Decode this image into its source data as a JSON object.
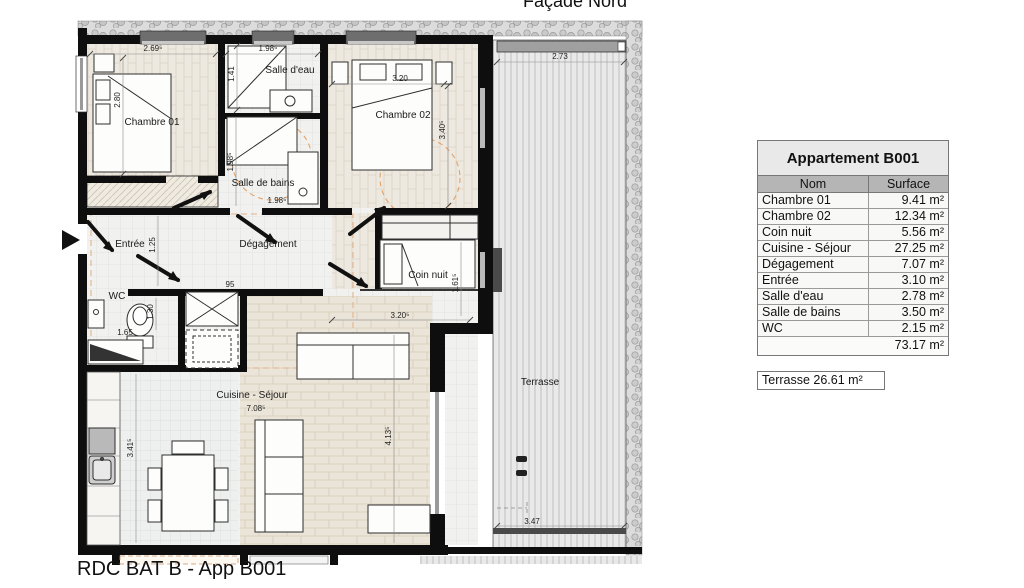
{
  "page": {
    "title": "Façade Nord",
    "footer": "RDC BAT B - App B001"
  },
  "plan": {
    "rooms": {
      "chambre01": "Chambre 01",
      "salle_eau": "Salle d'eau",
      "chambre02": "Chambre 02",
      "salle_bains": "Salle de bains",
      "entree": "Entrée",
      "degagement": "Dégagement",
      "coin_nuit": "Coin nuit",
      "wc": "WC",
      "cuisine_sejour": "Cuisine - Séjour",
      "terrasse": "Terrasse"
    },
    "dims": {
      "ch01_w": "2.69⁵",
      "ch01_h": "2.80",
      "sde_w": "1.98⁵",
      "sde_h": "1.41",
      "ch02_w": "3.20",
      "ch02_h": "3.40⁵",
      "sdb_w": "1.98⁵",
      "sdb_h": "1.98⁵",
      "entree_h": "1.25",
      "deg_w": "95",
      "wc_w": "1.65",
      "wc_h": "1.30",
      "cuisine_w": "7.08⁵",
      "cuisine_h": "3.41⁵",
      "sejour_h": "4.13⁵",
      "coin_w": "3.20⁵",
      "coin_h": "1.61⁵",
      "terrasse_w": "2.73",
      "terrasse_s": "3.47"
    }
  },
  "table": {
    "title": "Appartement B001",
    "columns": {
      "name": "Nom",
      "surface": "Surface"
    },
    "rows": [
      {
        "name": "Chambre 01",
        "surface": "9.41 m²"
      },
      {
        "name": "Chambre 02",
        "surface": "12.34 m²"
      },
      {
        "name": "Coin nuit",
        "surface": "5.56 m²"
      },
      {
        "name": "Cuisine - Séjour",
        "surface": "27.25 m²"
      },
      {
        "name": "Dégagement",
        "surface": "7.07 m²"
      },
      {
        "name": "Entrée",
        "surface": "3.10 m²"
      },
      {
        "name": "Salle d'eau",
        "surface": "2.78 m²"
      },
      {
        "name": "Salle de bains",
        "surface": "3.50 m²"
      },
      {
        "name": "WC",
        "surface": "2.15 m²"
      }
    ],
    "total": "73.17 m²",
    "terrasse_note": "Terrasse 26.61 m²"
  }
}
